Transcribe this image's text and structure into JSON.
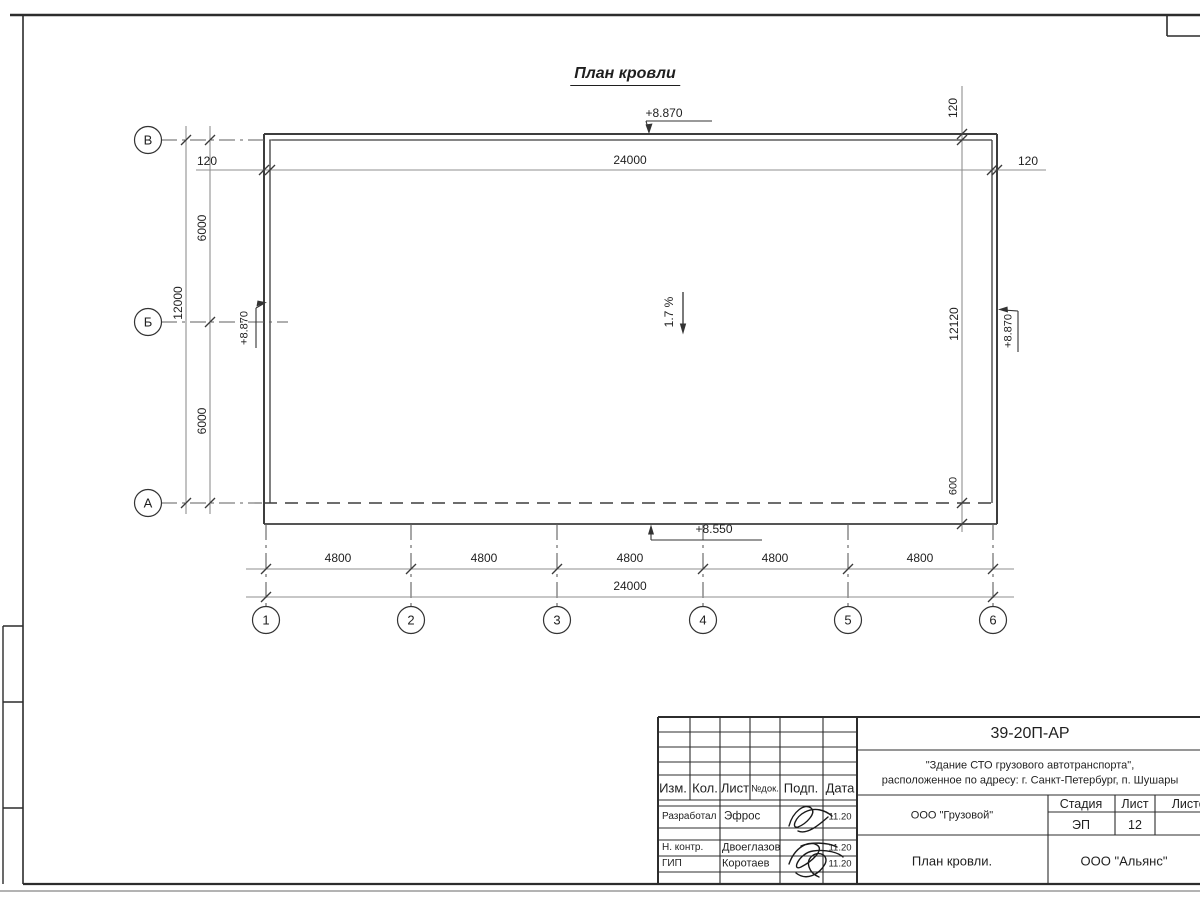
{
  "plan": {
    "title": "План кровли",
    "slope": "1.7 %",
    "elev_top": "+8.870",
    "elev_left": "+8.870",
    "elev_right": "+8.870",
    "elev_bottom": "+8.550",
    "dim_total_top": "24000",
    "dim_parapet_left": "120",
    "dim_parapet_right": "120",
    "dim_parapet_top": "120",
    "dim_span_upper": "6000",
    "dim_span_lower": "6000",
    "dim_total_left": "12000",
    "dim_right_height": "12120",
    "dim_overhang": "600",
    "dim_bottom_spans": [
      "4800",
      "4800",
      "4800",
      "4800",
      "4800"
    ],
    "dim_total_bottom": "24000",
    "row_axes": [
      "В",
      "Б",
      "А"
    ],
    "col_axes": [
      "1",
      "2",
      "3",
      "4",
      "5",
      "6"
    ]
  },
  "title_block": {
    "doc_code": "39-20П-АР",
    "project_line1": "\"Здание СТО грузового автотранспорта\",",
    "project_line2": "расположенное по адресу: г. Санкт-Петербург, п. Шушары",
    "header": {
      "izm": "Изм.",
      "kol": "Кол.",
      "list": "Лист",
      "ndok": "№док.",
      "podp": "Подп.",
      "data": "Дата"
    },
    "rows": [
      {
        "role": "Разработал",
        "name": "Эфрос",
        "date": "11.20"
      },
      {
        "role": "Н. контр.",
        "name": "Двоеглазов",
        "date": "11.20"
      },
      {
        "role": "ГИП",
        "name": "Коротаев",
        "date": "11.20"
      }
    ],
    "client": "ООО \"Грузовой\"",
    "stage_label": "Стадия",
    "sheet_label": "Лист",
    "sheets_label": "Листов",
    "stage_value": "ЭП",
    "sheet_value": "12",
    "sheet_name": "План кровли.",
    "company": "ООО \"Альянс\""
  }
}
